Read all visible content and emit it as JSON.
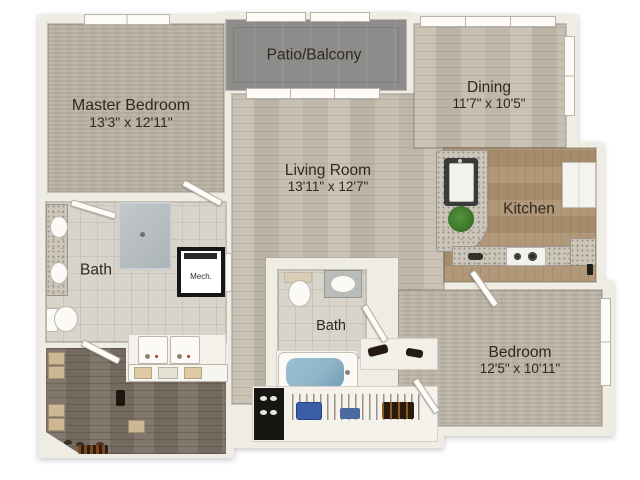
{
  "plan": {
    "rooms": [
      {
        "name": "Master Bedroom",
        "dims": "13'3\" x 12'11\""
      },
      {
        "name": "Patio/Balcony"
      },
      {
        "name": "Dining",
        "dims": "11'7\" x 10'5\""
      },
      {
        "name": "Living Room",
        "dims": "13'11\" x 12'7\""
      },
      {
        "name": "Kitchen"
      },
      {
        "name": "Bath"
      },
      {
        "name": "Bath"
      },
      {
        "name": "Bedroom",
        "dims": "12'5\" x 10'11\""
      },
      {
        "name": "Mech."
      }
    ],
    "colors": {
      "wall": "#efece4",
      "wood_floor": "#c3bbad",
      "carpet": "#b8b0a2",
      "patio_concrete": "#8d8c8a",
      "tile": "#d9d4ca",
      "closet_wood": "#7b7065",
      "kitchen_floor": "#ab9270",
      "granite": "#ccc6ba",
      "tub_water": "#8fb3c8"
    }
  }
}
